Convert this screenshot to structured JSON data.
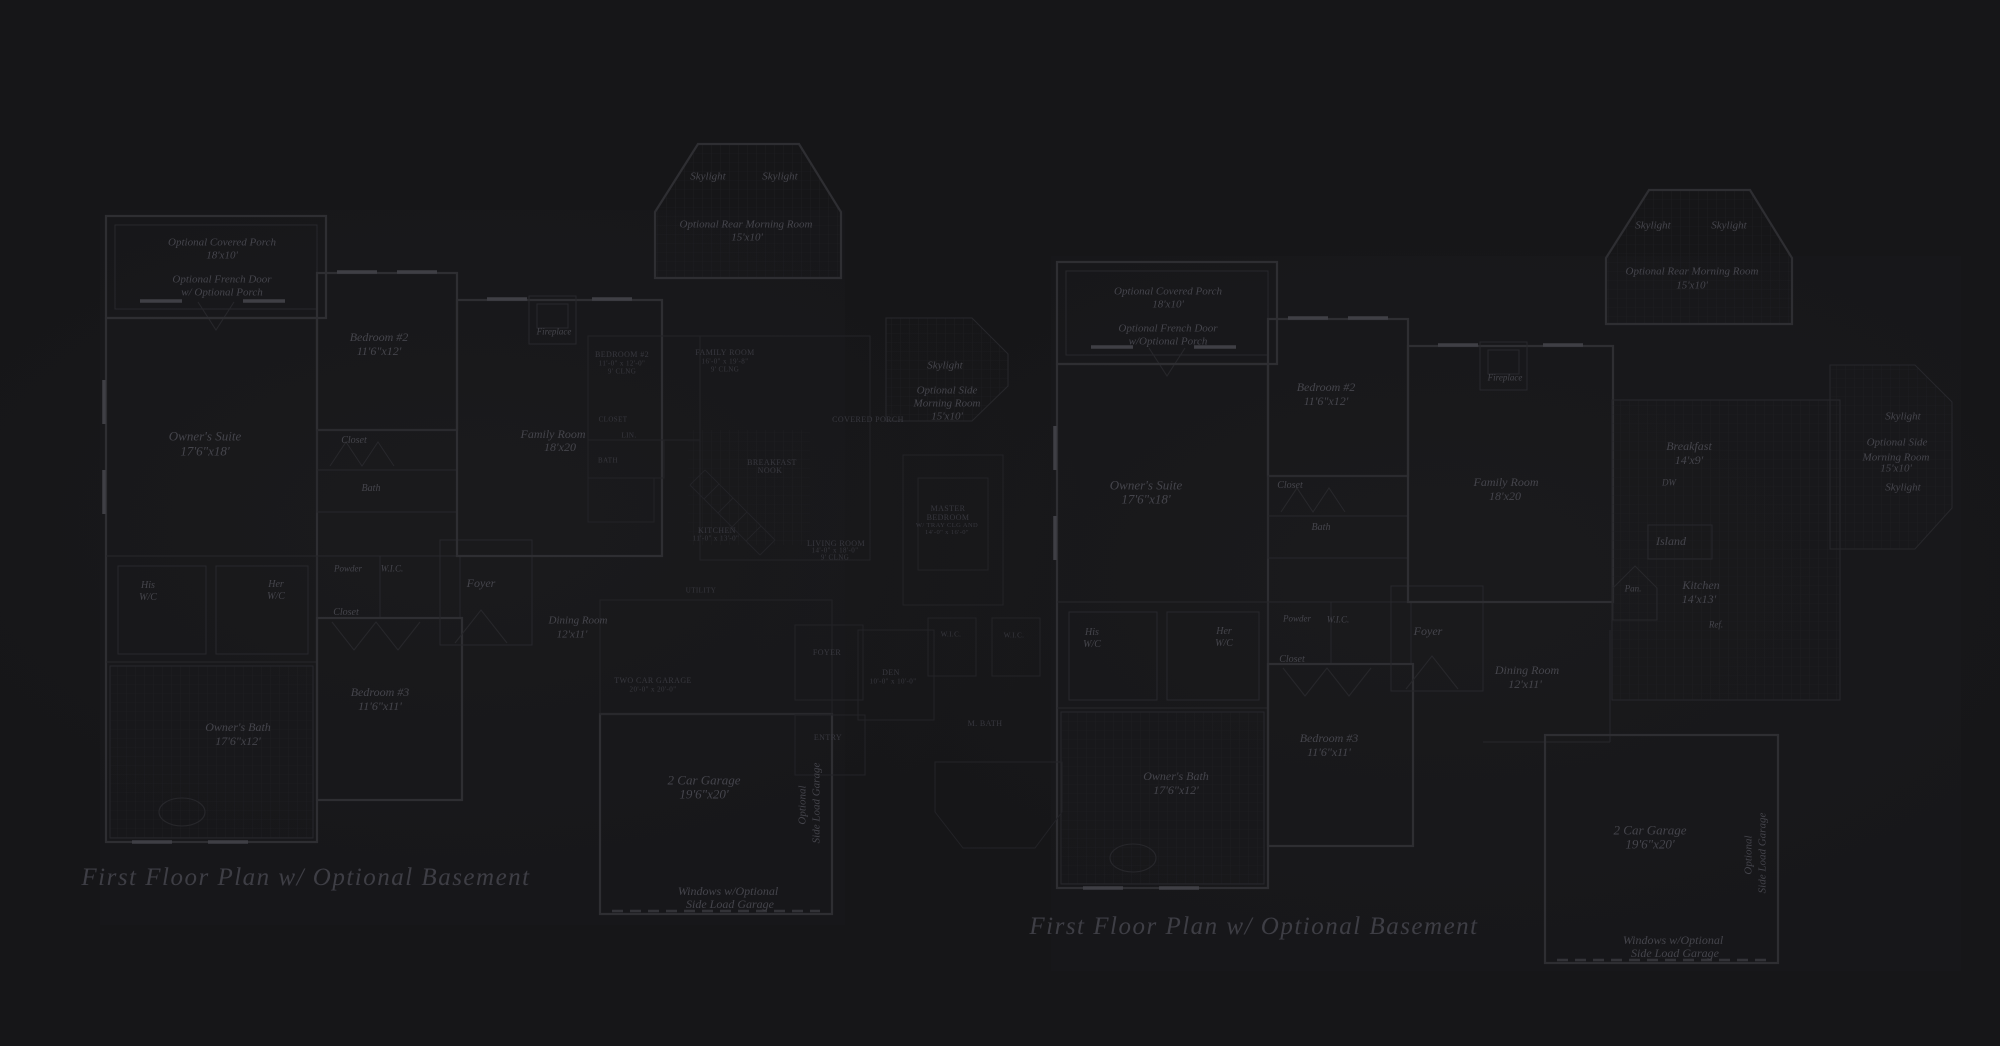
{
  "scene": {
    "background": "#161618",
    "wall_line": "#2e2e32",
    "fine_line": "#27272b",
    "label_text": "#45454c",
    "overlay_text": "#38383f",
    "title_text": "#3e3e45"
  },
  "titles": {
    "left": "First Floor Plan  w/ Optional Basement",
    "right": "First Floor Plan  w/ Optional Basement"
  },
  "plans": {
    "left": {
      "name": "first-floor-plan-left",
      "style": "lbl",
      "labels": [
        {
          "t": "Optional Covered Porch",
          "x": 222,
          "y": 243,
          "s": 11
        },
        {
          "t": "18'x10'",
          "x": 222,
          "y": 256,
          "s": 11
        },
        {
          "t": "Optional French Door",
          "x": 222,
          "y": 280,
          "s": 11
        },
        {
          "t": "w/ Optional Porch",
          "x": 222,
          "y": 293,
          "s": 11
        },
        {
          "t": "Owner's Suite",
          "x": 205,
          "y": 436,
          "s": 13
        },
        {
          "t": "17'6\"x18'",
          "x": 205,
          "y": 451,
          "s": 13
        },
        {
          "t": "Bedroom #2",
          "x": 379,
          "y": 337,
          "s": 12
        },
        {
          "t": "11'6\"x12'",
          "x": 379,
          "y": 351,
          "s": 12
        },
        {
          "t": "Closet",
          "x": 354,
          "y": 441,
          "s": 10
        },
        {
          "t": "Bath",
          "x": 371,
          "y": 489,
          "s": 10
        },
        {
          "t": "His",
          "x": 148,
          "y": 586,
          "s": 10
        },
        {
          "t": "W/C",
          "x": 148,
          "y": 598,
          "s": 10
        },
        {
          "t": "Her",
          "x": 276,
          "y": 585,
          "s": 10
        },
        {
          "t": "W/C",
          "x": 276,
          "y": 597,
          "s": 10
        },
        {
          "t": "Powder",
          "x": 348,
          "y": 569,
          "s": 9
        },
        {
          "t": "W.I.C.",
          "x": 392,
          "y": 569,
          "s": 9
        },
        {
          "t": "Closet",
          "x": 346,
          "y": 613,
          "s": 10
        },
        {
          "t": "Foyer",
          "x": 481,
          "y": 583,
          "s": 12
        },
        {
          "t": "Dining Room",
          "x": 578,
          "y": 621,
          "s": 11
        },
        {
          "t": "12'x11'",
          "x": 572,
          "y": 635,
          "s": 11
        },
        {
          "t": "Bedroom #3",
          "x": 380,
          "y": 692,
          "s": 12
        },
        {
          "t": "11'6\"x11'",
          "x": 380,
          "y": 706,
          "s": 12
        },
        {
          "t": "Owner's Bath",
          "x": 238,
          "y": 727,
          "s": 12
        },
        {
          "t": "17'6\"x12'",
          "x": 238,
          "y": 741,
          "s": 12
        },
        {
          "t": "Family Room",
          "x": 553,
          "y": 434,
          "s": 12
        },
        {
          "t": "18'x20",
          "x": 560,
          "y": 447,
          "s": 12
        },
        {
          "t": "Fireplace",
          "x": 554,
          "y": 332,
          "s": 9
        },
        {
          "t": "Skylight",
          "x": 708,
          "y": 177,
          "s": 11
        },
        {
          "t": "Skylight",
          "x": 780,
          "y": 177,
          "s": 11
        },
        {
          "t": "Optional Rear Morning Room",
          "x": 746,
          "y": 225,
          "s": 11
        },
        {
          "t": "15'x10'",
          "x": 747,
          "y": 238,
          "s": 11
        },
        {
          "t": "Skylight",
          "x": 945,
          "y": 366,
          "s": 11
        },
        {
          "t": "Optional Side",
          "x": 947,
          "y": 391,
          "s": 11
        },
        {
          "t": "Morning Room",
          "x": 947,
          "y": 404,
          "s": 11
        },
        {
          "t": "15'x10'",
          "x": 947,
          "y": 417,
          "s": 11
        },
        {
          "t": "2 Car Garage",
          "x": 704,
          "y": 780,
          "s": 13
        },
        {
          "t": "19'6\"x20'",
          "x": 704,
          "y": 794,
          "s": 13
        },
        {
          "t": "Windows w/Optional",
          "x": 728,
          "y": 891,
          "s": 12
        },
        {
          "t": "Side Load Garage",
          "x": 730,
          "y": 904,
          "s": 12
        },
        {
          "t": "Optional",
          "x": 803,
          "y": 805,
          "s": 11,
          "r": -90
        },
        {
          "t": "Side Load Garage",
          "x": 817,
          "y": 803,
          "s": 11,
          "r": -90
        }
      ]
    },
    "right": {
      "name": "first-floor-plan-right",
      "style": "lbl",
      "labels": [
        {
          "t": "Optional Covered Porch",
          "x": 1168,
          "y": 292,
          "s": 11
        },
        {
          "t": "18'x10'",
          "x": 1168,
          "y": 305,
          "s": 11
        },
        {
          "t": "Optional French Door",
          "x": 1168,
          "y": 329,
          "s": 11
        },
        {
          "t": "w/Optional Porch",
          "x": 1168,
          "y": 342,
          "s": 11
        },
        {
          "t": "Owner's Suite",
          "x": 1146,
          "y": 485,
          "s": 13
        },
        {
          "t": "17'6\"x18'",
          "x": 1146,
          "y": 499,
          "s": 13
        },
        {
          "t": "Bedroom #2",
          "x": 1326,
          "y": 387,
          "s": 12
        },
        {
          "t": "11'6\"x12'",
          "x": 1326,
          "y": 401,
          "s": 12
        },
        {
          "t": "Closet",
          "x": 1290,
          "y": 486,
          "s": 10
        },
        {
          "t": "Bath",
          "x": 1321,
          "y": 528,
          "s": 10
        },
        {
          "t": "His",
          "x": 1092,
          "y": 633,
          "s": 10
        },
        {
          "t": "W/C",
          "x": 1092,
          "y": 645,
          "s": 10
        },
        {
          "t": "Her",
          "x": 1224,
          "y": 632,
          "s": 10
        },
        {
          "t": "W/C",
          "x": 1224,
          "y": 644,
          "s": 10
        },
        {
          "t": "Powder",
          "x": 1297,
          "y": 619,
          "s": 9
        },
        {
          "t": "W.I.C.",
          "x": 1338,
          "y": 620,
          "s": 9
        },
        {
          "t": "Closet",
          "x": 1292,
          "y": 660,
          "s": 10
        },
        {
          "t": "Foyer",
          "x": 1428,
          "y": 631,
          "s": 12
        },
        {
          "t": "Dining Room",
          "x": 1527,
          "y": 670,
          "s": 12
        },
        {
          "t": "12'x11'",
          "x": 1525,
          "y": 684,
          "s": 12
        },
        {
          "t": "Bedroom #3",
          "x": 1329,
          "y": 738,
          "s": 12
        },
        {
          "t": "11'6\"x11'",
          "x": 1329,
          "y": 752,
          "s": 12
        },
        {
          "t": "Owner's Bath",
          "x": 1176,
          "y": 776,
          "s": 12
        },
        {
          "t": "17'6\"x12'",
          "x": 1176,
          "y": 790,
          "s": 12
        },
        {
          "t": "Family Room",
          "x": 1506,
          "y": 482,
          "s": 12
        },
        {
          "t": "18'x20",
          "x": 1505,
          "y": 496,
          "s": 12
        },
        {
          "t": "Fireplace",
          "x": 1505,
          "y": 378,
          "s": 9
        },
        {
          "t": "Breakfast",
          "x": 1689,
          "y": 446,
          "s": 12
        },
        {
          "t": "14'x9'",
          "x": 1689,
          "y": 460,
          "s": 12
        },
        {
          "t": "DW",
          "x": 1669,
          "y": 483,
          "s": 9
        },
        {
          "t": "Island",
          "x": 1671,
          "y": 541,
          "s": 12
        },
        {
          "t": "Kitchen",
          "x": 1701,
          "y": 585,
          "s": 12
        },
        {
          "t": "14'x13'",
          "x": 1699,
          "y": 599,
          "s": 12
        },
        {
          "t": "Pan.",
          "x": 1633,
          "y": 589,
          "s": 9
        },
        {
          "t": "Ref.",
          "x": 1716,
          "y": 625,
          "s": 9
        },
        {
          "t": "Skylight",
          "x": 1653,
          "y": 226,
          "s": 11
        },
        {
          "t": "Skylight",
          "x": 1729,
          "y": 226,
          "s": 11
        },
        {
          "t": "Optional Rear Morning Room",
          "x": 1692,
          "y": 272,
          "s": 11
        },
        {
          "t": "15'x10'",
          "x": 1692,
          "y": 286,
          "s": 11
        },
        {
          "t": "Skylight",
          "x": 1903,
          "y": 417,
          "s": 11
        },
        {
          "t": "Optional Side",
          "x": 1897,
          "y": 443,
          "s": 11
        },
        {
          "t": "Morning Room",
          "x": 1896,
          "y": 458,
          "s": 11
        },
        {
          "t": "15'x10'",
          "x": 1896,
          "y": 469,
          "s": 11
        },
        {
          "t": "Skylight",
          "x": 1903,
          "y": 488,
          "s": 11
        },
        {
          "t": "2 Car Garage",
          "x": 1650,
          "y": 830,
          "s": 13
        },
        {
          "t": "19'6\"x20'",
          "x": 1650,
          "y": 844,
          "s": 13
        },
        {
          "t": "Windows w/Optional",
          "x": 1673,
          "y": 940,
          "s": 12
        },
        {
          "t": "Side Load Garage",
          "x": 1675,
          "y": 953,
          "s": 12
        },
        {
          "t": "Optional",
          "x": 1749,
          "y": 855,
          "s": 11,
          "r": -90
        },
        {
          "t": "Side Load Garage",
          "x": 1763,
          "y": 853,
          "s": 11,
          "r": -90
        }
      ]
    },
    "overlay": {
      "name": "underlay-plan-center",
      "style": "ovl",
      "labels": [
        {
          "t": "BEDROOM #2",
          "x": 622,
          "y": 355,
          "s": 8
        },
        {
          "t": "11'-0\" x 12'-0\"",
          "x": 622,
          "y": 364,
          "s": 7
        },
        {
          "t": "9' CLNG",
          "x": 622,
          "y": 372,
          "s": 7
        },
        {
          "t": "FAMILY ROOM",
          "x": 725,
          "y": 353,
          "s": 8
        },
        {
          "t": "16'-0\" x 19'-8\"",
          "x": 725,
          "y": 362,
          "s": 7
        },
        {
          "t": "9' CLNG",
          "x": 725,
          "y": 370,
          "s": 7
        },
        {
          "t": "CLOSET",
          "x": 613,
          "y": 420,
          "s": 7
        },
        {
          "t": "LIN.",
          "x": 629,
          "y": 436,
          "s": 7
        },
        {
          "t": "BATH",
          "x": 608,
          "y": 461,
          "s": 7
        },
        {
          "t": "BREAKFAST",
          "x": 772,
          "y": 463,
          "s": 8
        },
        {
          "t": "NOOK",
          "x": 770,
          "y": 471,
          "s": 8
        },
        {
          "t": "KITCHEN",
          "x": 717,
          "y": 531,
          "s": 8
        },
        {
          "t": "11'-0\" x 13'-0\"",
          "x": 716,
          "y": 539,
          "s": 7
        },
        {
          "t": "LIVING ROOM",
          "x": 836,
          "y": 544,
          "s": 8
        },
        {
          "t": "14'-0\" x 18'-0\"",
          "x": 835,
          "y": 551,
          "s": 7
        },
        {
          "t": "9' CLNG",
          "x": 835,
          "y": 558,
          "s": 7
        },
        {
          "t": "UTILITY",
          "x": 701,
          "y": 591,
          "s": 7
        },
        {
          "t": "TWO CAR GARAGE",
          "x": 653,
          "y": 681,
          "s": 8
        },
        {
          "t": "20'-0\" x 20'-0\"",
          "x": 653,
          "y": 690,
          "s": 7
        },
        {
          "t": "COVERED PORCH",
          "x": 868,
          "y": 420,
          "s": 8
        },
        {
          "t": "FOYER",
          "x": 827,
          "y": 653,
          "s": 8
        },
        {
          "t": "DEN",
          "x": 891,
          "y": 673,
          "s": 8
        },
        {
          "t": "10'-0\" x 10'-0\"",
          "x": 893,
          "y": 682,
          "s": 7
        },
        {
          "t": "W.I.C.",
          "x": 951,
          "y": 635,
          "s": 7
        },
        {
          "t": "W.I.C.",
          "x": 1014,
          "y": 636,
          "s": 7
        },
        {
          "t": "MASTER",
          "x": 948,
          "y": 509,
          "s": 8
        },
        {
          "t": "BEDROOM",
          "x": 948,
          "y": 518,
          "s": 8
        },
        {
          "t": "W/ TRAY CLG AND",
          "x": 947,
          "y": 526,
          "s": 6.5
        },
        {
          "t": "14'-0\" x 16'-0\"",
          "x": 947,
          "y": 533,
          "s": 6.5
        },
        {
          "t": "M. BATH",
          "x": 985,
          "y": 724,
          "s": 8
        },
        {
          "t": "ENTRY",
          "x": 828,
          "y": 738,
          "s": 8
        }
      ]
    }
  }
}
